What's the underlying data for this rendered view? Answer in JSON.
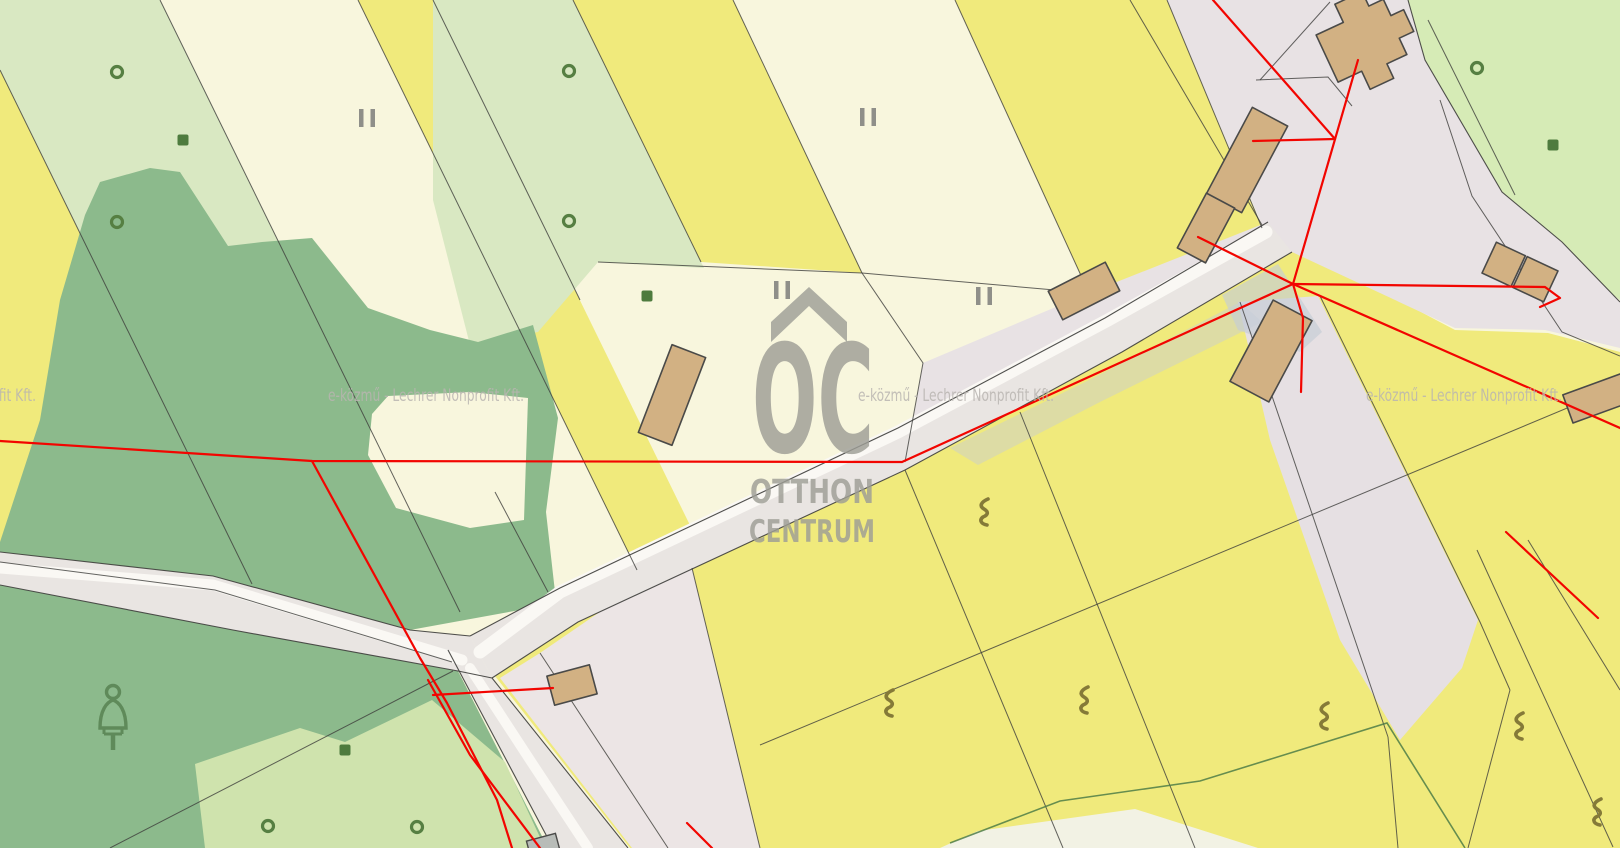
{
  "watermark": {
    "provider_text": "e-közmű - Lechrer Nonprofit Kft.",
    "logo": {
      "monogram": "OC",
      "word1": "OTTHON",
      "word2": "CENTRUM"
    }
  },
  "colors": {
    "yellow": "#f0ea7c",
    "cream": "#f8f6dd",
    "lgreen": "#d9e8c2",
    "trgreen": "#d6ebb6",
    "forest": "#8cba8c",
    "patchgreen": "#cfe3ad",
    "road": "#e9e5e2",
    "yard": "#e8e2e4",
    "pink": "#ece5e5",
    "band": "#e6e0e3",
    "bluegray": "#c5ccd6",
    "building": "#d2b183",
    "building-stroke": "#4a4a48",
    "boundary": "#3d3d3b",
    "greenline": "#4e7d46",
    "red": "#f20500",
    "wmtext": "#b9b5b1",
    "logo": "#9e9e96",
    "symbol-green": "#567f42",
    "symbol-gray": "#8f8f89",
    "symbol-olive": "#857a38"
  },
  "map_symbols": {
    "ring": "sapling-ring-icon",
    "square": "shrub-square-icon",
    "double_bar": "meadow-double-bar-icon",
    "squiggle": "pasture-squiggle-icon",
    "conifer": "conifer-tree-icon"
  }
}
